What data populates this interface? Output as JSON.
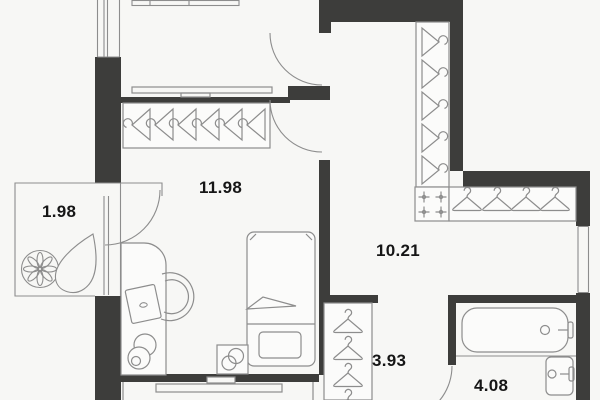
{
  "title": "Apartment floor plan",
  "colors": {
    "background": "#f7f7f5",
    "wall": "#3d3d3b",
    "line": "#8d8d8d",
    "text": "#161616"
  },
  "rooms": [
    {
      "name": "balcony",
      "area": "1.98"
    },
    {
      "name": "bedroom",
      "area": "11.98"
    },
    {
      "name": "hallway",
      "area": "10.21"
    },
    {
      "name": "corridor",
      "area": "3.93"
    },
    {
      "name": "bathroom",
      "area": "4.08"
    }
  ],
  "furniture_icons": [
    "bed",
    "pillow",
    "blanket",
    "nightstand",
    "desk",
    "office-chair",
    "laptop",
    "stool",
    "plant-flower",
    "plant-leaf",
    "wardrobe-hangers-profile",
    "wardrobe-hangers-front",
    "spotlight-crosses",
    "shelf",
    "counter",
    "bathtub",
    "sink",
    "door-swing",
    "window"
  ]
}
